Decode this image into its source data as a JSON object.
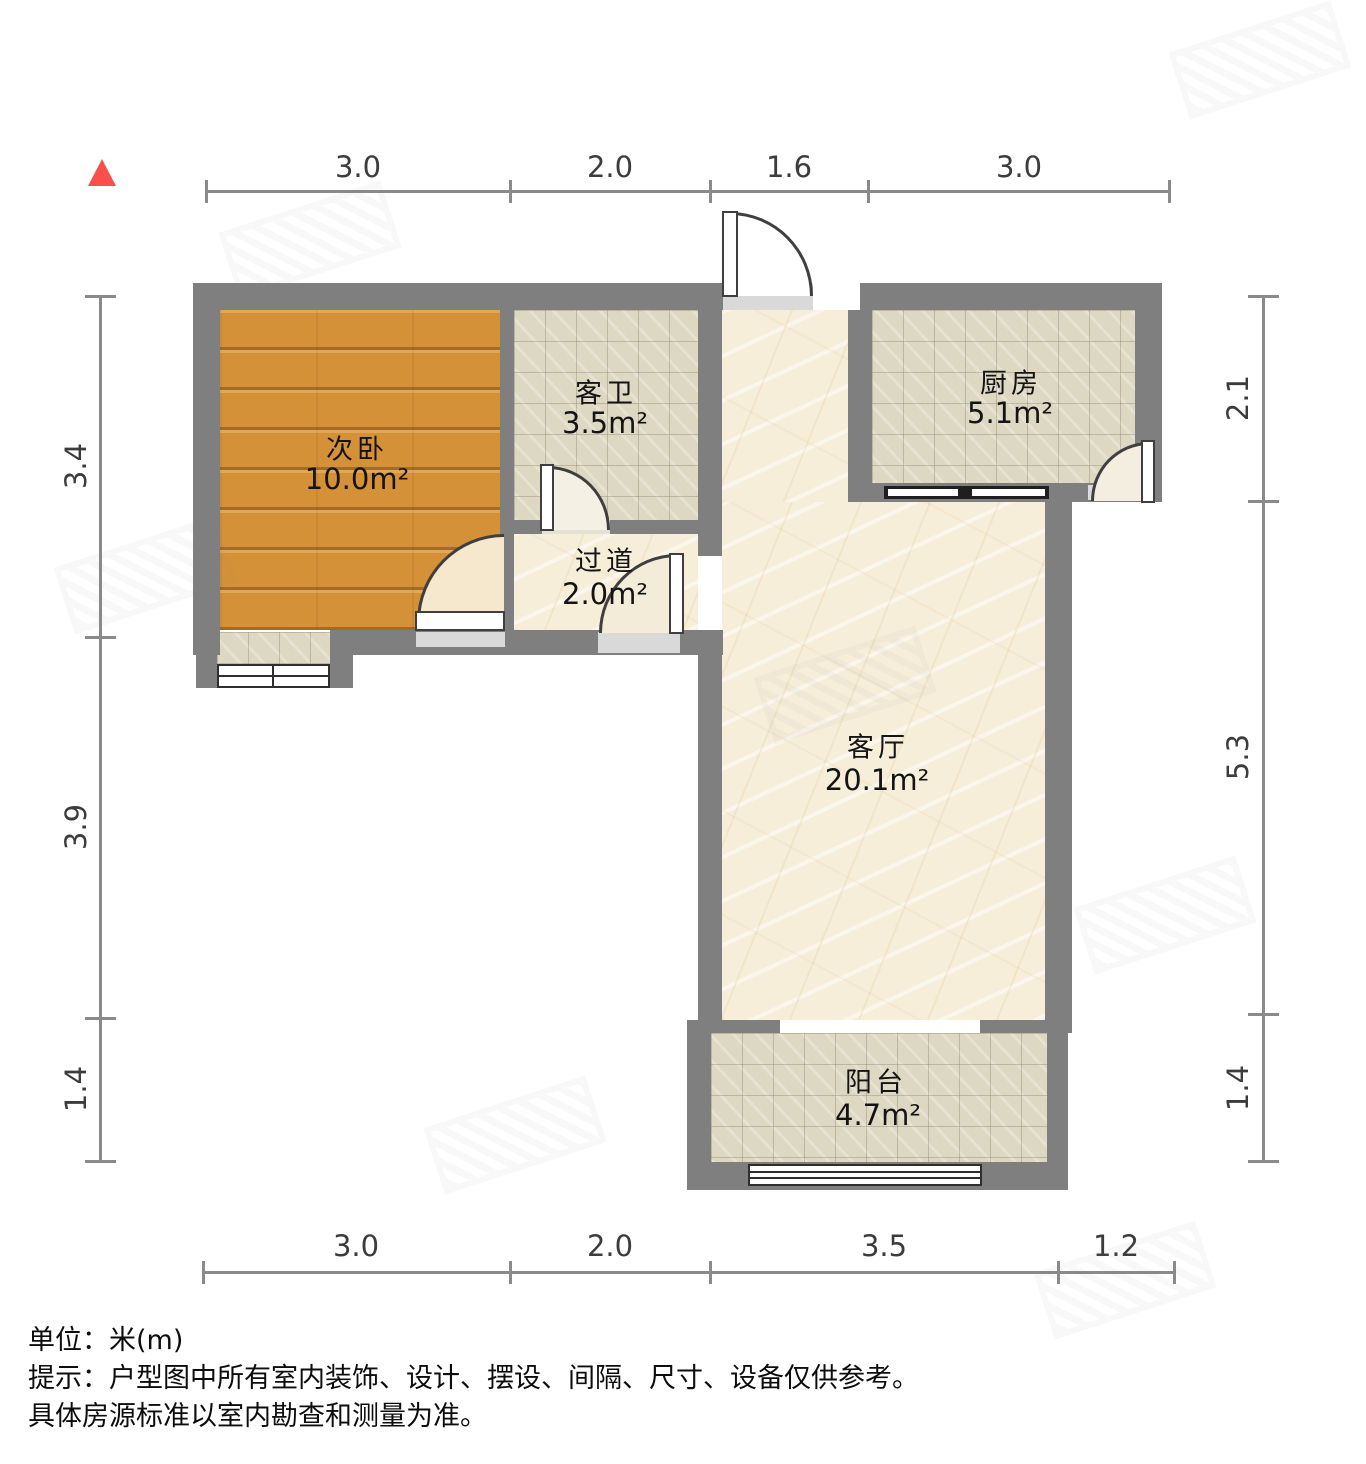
{
  "rooms": [
    {
      "name": "次卧",
      "area": "10.0m²"
    },
    {
      "name": "客卫",
      "area": "3.5m²"
    },
    {
      "name": "厨房",
      "area": "5.1m²"
    },
    {
      "name": "过道",
      "area": "2.0m²"
    },
    {
      "name": "客厅",
      "area": "20.1m²"
    },
    {
      "name": "阳台",
      "area": "4.7m²"
    }
  ],
  "dimensions": {
    "top": [
      "3.0",
      "2.0",
      "1.6",
      "3.0"
    ],
    "bottom": [
      "3.0",
      "2.0",
      "3.5",
      "1.2"
    ],
    "left": [
      "3.4",
      "3.9",
      "1.4"
    ],
    "right": [
      "2.1",
      "5.3",
      "1.4"
    ]
  },
  "notes": {
    "unit_label": "单位：米(m)",
    "tip_line1": "提示：户型图中所有室内装饰、设计、摆设、间隔、尺寸、设备仅供参考。",
    "tip_line2": "具体房源标准以室内勘查和测量为准。"
  },
  "colors": {
    "wall": "#7f7f7f",
    "wood_floor": "#d59138",
    "tile_floor": "#ddd8c2",
    "marble_floor": "#f7eeda",
    "north_arrow": "#f9504e",
    "dimension_line": "#8a8a8a"
  }
}
